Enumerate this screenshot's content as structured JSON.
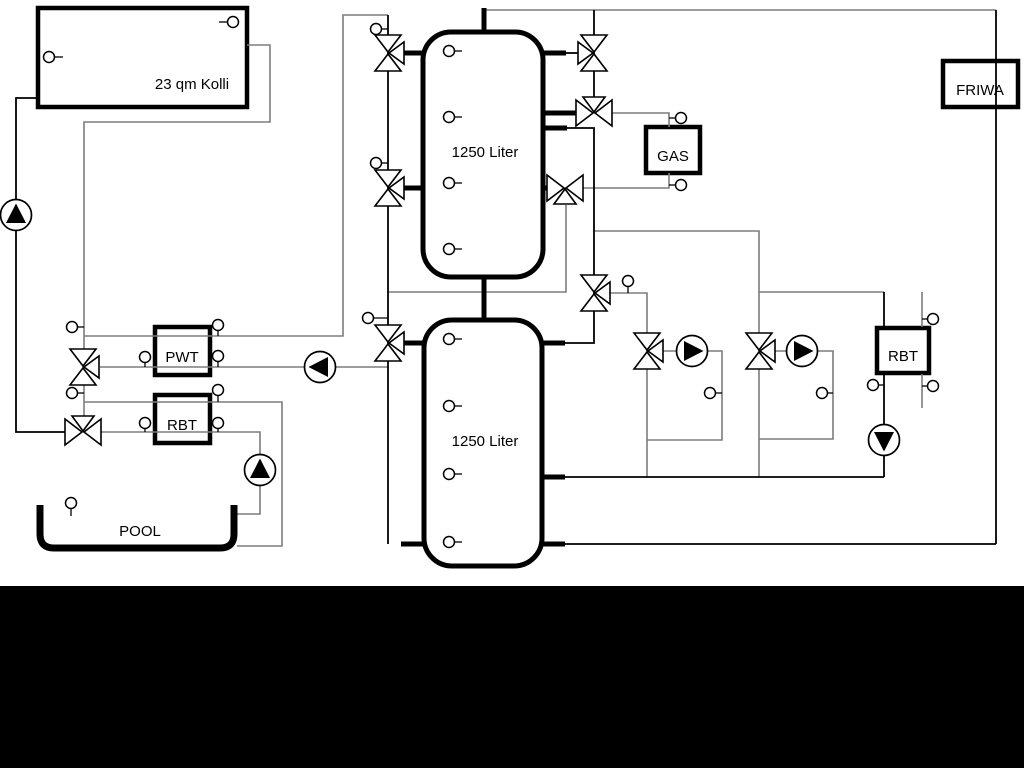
{
  "diagram": {
    "collector": {
      "label": "23 qm Kolli"
    },
    "buffer_tank_top": {
      "label": "1250 Liter"
    },
    "buffer_tank_bottom": {
      "label": "1250 Liter"
    },
    "heat_exchanger_pwt": {
      "label": "PWT"
    },
    "heat_exchanger_rbt_left": {
      "label": "RBT"
    },
    "gas_boiler": {
      "label": "GAS"
    },
    "heat_exchanger_rbt_right": {
      "label": "RBT"
    },
    "fresh_water_station": {
      "label": "FRIWA"
    },
    "pool": {
      "label": "POOL"
    }
  },
  "colors": {
    "pipe_gray": "#7d7d7d",
    "pipe_black": "#000000",
    "background": "#ffffff",
    "footer_bar": "#000000"
  }
}
